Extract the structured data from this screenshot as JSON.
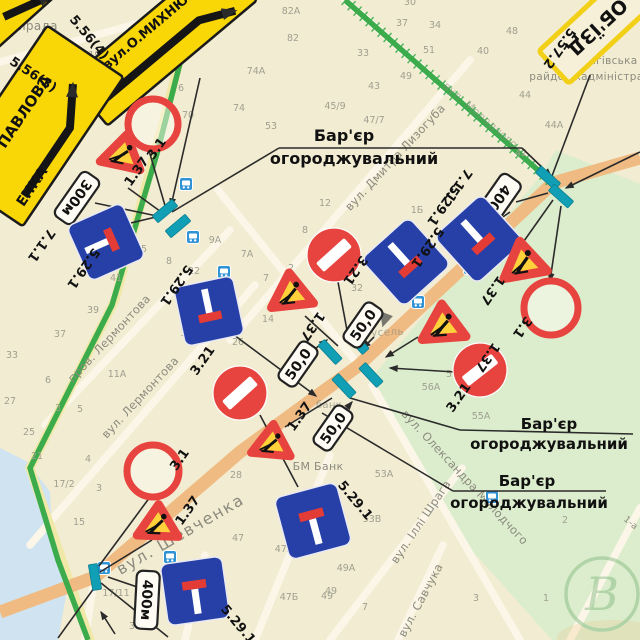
{
  "colors": {
    "paper": "#f2ecd2",
    "park": "#dcedcd",
    "river": "#cfe4f0",
    "street_white": "#fbf6e8",
    "street_yellow": "#f0e8a6",
    "road_orange": "#f0bb82",
    "route_green": "#3bab4b",
    "barrier_teal": "#109fb5",
    "sign_blue": "#2640a8",
    "sign_red": "#e8443f",
    "works_yellow": "#ffd23c",
    "detour_yellow": "#f9d606",
    "plate_face": "#fdfbf3",
    "ink": "#111111",
    "map_gray": "#8b8b7e",
    "number_gray": "#a0a090",
    "line_black": "#2b2b2b"
  },
  "base": {
    "park_poly": "556,150 640,184 640,640 552,640 452,528 368,382 542,174",
    "river_poly": "0,448 28,462 50,492 52,538 68,585 58,640 0,640",
    "streets_white": [
      [
        470,
        60,
        230,
        340
      ],
      [
        230,
        230,
        45,
        425
      ],
      [
        255,
        285,
        30,
        545
      ],
      [
        356,
        362,
        218,
        190
      ],
      [
        372,
        385,
        520,
        640
      ],
      [
        462,
        468,
        330,
        640
      ],
      [
        443,
        545,
        398,
        640
      ],
      [
        0,
        62,
        150,
        20
      ],
      [
        640,
        508,
        570,
        640
      ],
      [
        95,
        573,
        85,
        640
      ],
      [
        330,
        455,
        255,
        640
      ],
      [
        205,
        555,
        185,
        640
      ],
      [
        345,
        0,
        556,
        186
      ]
    ],
    "streets_yellow": [
      [
        196,
        0,
        115,
        300
      ],
      [
        115,
        300,
        30,
        468
      ],
      [
        30,
        468,
        90,
        640
      ]
    ],
    "road_orange": "640,158 553,183 358,366 240,452 95,577 0,612",
    "route_green_main": "196,0 158,150 112,305 30,468 58,560 88,640",
    "route_green_hatched": "345,0 556,186"
  },
  "connectors": [
    [
      200,
      78,
      171,
      206,
      1
    ],
    [
      95,
      203,
      157,
      216,
      0
    ],
    [
      148,
      147,
      166,
      209,
      0
    ],
    [
      128,
      188,
      164,
      214,
      0
    ],
    [
      118,
      226,
      156,
      217,
      0
    ],
    [
      172,
      212,
      279,
      148,
      0
    ],
    [
      279,
      148,
      522,
      148,
      0
    ],
    [
      522,
      148,
      551,
      176,
      1
    ],
    [
      640,
      152,
      566,
      188,
      1
    ],
    [
      590,
      75,
      552,
      176,
      0
    ],
    [
      553,
      200,
      524,
      241,
      0
    ],
    [
      561,
      206,
      550,
      281,
      1
    ],
    [
      548,
      193,
      516,
      202,
      0
    ],
    [
      510,
      212,
      487,
      228,
      0
    ],
    [
      338,
      282,
      349,
      341,
      0
    ],
    [
      305,
      316,
      338,
      346,
      0
    ],
    [
      230,
      332,
      316,
      396,
      1
    ],
    [
      260,
      415,
      298,
      487,
      0
    ],
    [
      418,
      337,
      386,
      357,
      1
    ],
    [
      455,
      372,
      390,
      368,
      1
    ],
    [
      285,
      427,
      332,
      398,
      0
    ],
    [
      150,
      497,
      99,
      566,
      0
    ],
    [
      152,
      540,
      100,
      572,
      0
    ],
    [
      101,
      583,
      168,
      637,
      0
    ],
    [
      97,
      584,
      58,
      638,
      0
    ],
    [
      108,
      577,
      146,
      590,
      0
    ],
    [
      115,
      634,
      101,
      612,
      1
    ],
    [
      312,
      351,
      327,
      340,
      1
    ],
    [
      374,
      337,
      363,
      348,
      1
    ],
    [
      341,
      415,
      352,
      402,
      1
    ],
    [
      350,
      398,
      460,
      430,
      0
    ],
    [
      460,
      430,
      633,
      434,
      0
    ],
    [
      322,
      413,
      453,
      491,
      0
    ],
    [
      453,
      491,
      606,
      491,
      0
    ]
  ],
  "barriers": [
    [
      330,
      352,
      47
    ],
    [
      357,
      342,
      47
    ],
    [
      344,
      386,
      47
    ],
    [
      371,
      375,
      47
    ],
    [
      165,
      211,
      -40
    ],
    [
      178,
      226,
      -40
    ],
    [
      548,
      178,
      42
    ],
    [
      561,
      196,
      42
    ],
    [
      95,
      577,
      80
    ]
  ],
  "bus_stops": [
    [
      186,
      184
    ],
    [
      193,
      237
    ],
    [
      224,
      272
    ],
    [
      470,
      268
    ],
    [
      418,
      302
    ],
    [
      492,
      497
    ],
    [
      170,
      557
    ],
    [
      104,
      568
    ]
  ],
  "pointer_icons": [
    [
      382,
      318,
      -15
    ]
  ],
  "signs": {
    "rings": [
      [
        153,
        124,
        25
      ],
      [
        551,
        308,
        27
      ],
      [
        153,
        471,
        26
      ]
    ],
    "no_entry": [
      [
        334,
        255,
        27,
        -42
      ],
      [
        240,
        393,
        27,
        -42
      ],
      [
        480,
        370,
        27,
        -38
      ]
    ],
    "roadworks": [
      [
        123,
        152,
        28,
        12
      ],
      [
        291,
        291,
        29,
        -6
      ],
      [
        443,
        323,
        30,
        -4
      ],
      [
        523,
        260,
        30,
        -10
      ],
      [
        272,
        441,
        27,
        5
      ],
      [
        158,
        522,
        28,
        2
      ]
    ],
    "dead_end": [
      [
        106,
        242,
        -24,
        60,
        90
      ],
      [
        209,
        311,
        -12,
        60,
        180
      ],
      [
        479,
        239,
        -42,
        64,
        180
      ],
      [
        406,
        262,
        -42,
        64,
        180
      ],
      [
        313,
        521,
        -15,
        64,
        0
      ],
      [
        195,
        591,
        -8,
        62,
        0
      ]
    ],
    "plates": [
      {
        "t": "300м",
        "x": 77,
        "y": 198,
        "r": 125,
        "w": 54,
        "h": 22
      },
      {
        "t": "400м",
        "x": 496,
        "y": 203,
        "r": 125,
        "w": 60,
        "h": 24
      },
      {
        "t": "400м",
        "x": 147,
        "y": 600,
        "r": 93,
        "w": 58,
        "h": 23
      },
      {
        "t": "50,0",
        "x": 298,
        "y": 364,
        "r": -55,
        "w": 46,
        "h": 21
      },
      {
        "t": "50,0",
        "x": 363,
        "y": 325,
        "r": -55,
        "w": 46,
        "h": 21
      },
      {
        "t": "50,0",
        "x": 333,
        "y": 428,
        "r": -55,
        "w": 46,
        "h": 21
      }
    ],
    "labels": [
      [
        "5.56(4)",
        86,
        40,
        50
      ],
      [
        "5.56(3)",
        31,
        78,
        33
      ],
      [
        "5.57.2",
        556,
        46,
        125
      ],
      [
        "7.1.1",
        38,
        243,
        125
      ],
      [
        "5.29.1",
        80,
        266,
        125
      ],
      [
        "5.29.1",
        173,
        283,
        125
      ],
      [
        "3.1",
        160,
        151,
        -55
      ],
      [
        "1.37",
        140,
        174,
        -55
      ],
      [
        "3.21",
        352,
        268,
        125
      ],
      [
        "3.21",
        206,
        363,
        -55
      ],
      [
        "3.21",
        462,
        400,
        -55
      ],
      [
        "1.37",
        309,
        324,
        125
      ],
      [
        "1.37",
        303,
        419,
        -55
      ],
      [
        "1.37",
        484,
        355,
        125
      ],
      [
        "1.37",
        489,
        288,
        125
      ],
      [
        "3.1",
        519,
        325,
        125
      ],
      [
        "3.1",
        183,
        462,
        -55
      ],
      [
        "1.37",
        191,
        513,
        -55
      ],
      [
        "7.1.1",
        455,
        183,
        125
      ],
      [
        "5.29.1",
        440,
        203,
        125
      ],
      [
        "5.29.1",
        424,
        245,
        125
      ],
      [
        "5.29.1",
        352,
        503,
        50
      ],
      [
        "5.29.1",
        235,
        627,
        50
      ]
    ]
  },
  "yellow_signs": [
    {
      "id": "detour-street-sign-mykhnyuka",
      "x": 163,
      "y": 40,
      "r": -40,
      "w": 195,
      "h": 60,
      "face": "#f9d606",
      "edge": "#1a1a1a",
      "ew": 2.5,
      "texts": [
        {
          "t": "вул.О.МИХНЮКА",
          "x": 2,
          "y": -13,
          "s": 13
        }
      ],
      "arrow": "M -80,8 L 40,8 L 74,24"
    },
    {
      "id": "detour-street-sign-pavlova",
      "x": 35,
      "y": 126,
      "r": -56,
      "w": 180,
      "h": 92,
      "face": "#f9d606",
      "edge": "#1a1a1a",
      "ew": 2.5,
      "texts": [
        {
          "t": "ПАВЛОВА",
          "x": 6,
          "y": -12,
          "s": 15
        },
        {
          "t": "ЕНКА",
          "x": -52,
          "y": 36,
          "s": 14
        }
      ],
      "arrow": "M -64,30 L 18,30 L 56,8"
    },
    {
      "id": "detour-street-sign-corner",
      "x": 12,
      "y": -4,
      "r": -42,
      "w": 150,
      "h": 58,
      "face": "#f9d606",
      "edge": "#1a1a1a",
      "ew": 2.5,
      "texts": [
        {
          "t": "ЕНКА",
          "x": 30,
          "y": 24,
          "s": 13
        }
      ],
      "arrow": "M -20,10 L 30,26"
    },
    {
      "id": "detour-plate-objizd",
      "x": 597,
      "y": 27,
      "r": 137,
      "w": 118,
      "h": 44,
      "face": "#f7f0d8",
      "edge": "#f2d018",
      "ew": 5,
      "texts": [
        {
          "t": "ОБ'ЇЗД",
          "x": 0,
          "y": 6,
          "s": 19
        }
      ],
      "arrow": null
    }
  ],
  "barrier_notes": [
    {
      "l1": "Бар'єр",
      "l2": "огороджувальний",
      "x1": 344,
      "y1": 141,
      "x2": 354,
      "y2": 164,
      "s": 16
    },
    {
      "l1": "Бар'єр",
      "l2": "огороджувальний",
      "x1": 549,
      "y1": 429,
      "x2": 549,
      "y2": 449,
      "s": 15
    },
    {
      "l1": "Бар'єр",
      "l2": "огороджувальний",
      "x1": 527,
      "y1": 486,
      "x2": 529,
      "y2": 508,
      "s": 15
    }
  ],
  "street_labels": [
    {
      "t": "райрада",
      "x": 30,
      "y": 30,
      "r": 0,
      "s": 12,
      "o": 1
    },
    {
      "t": "вул. Дмитра Лизогуба",
      "x": 398,
      "y": 160,
      "r": -47,
      "s": 11.5,
      "o": 1
    },
    {
      "t": "пров. Лермонтова",
      "x": 112,
      "y": 341,
      "r": -47,
      "s": 11.5,
      "o": 1
    },
    {
      "t": "вул. Лермонтова",
      "x": 143,
      "y": 400,
      "r": -47,
      "s": 11.5,
      "o": 1
    },
    {
      "t": "вул. Шевченка",
      "x": 183,
      "y": 539,
      "r": -30,
      "s": 16,
      "o": 1
    },
    {
      "t": "вул. Олександра Молодчого",
      "x": 462,
      "y": 480,
      "r": 47,
      "s": 11.5,
      "o": 1
    },
    {
      "t": "вул. Іллі Шрага",
      "x": 424,
      "y": 524,
      "r": -56,
      "s": 11.5,
      "o": 1
    },
    {
      "t": "вул. Савчука",
      "x": 424,
      "y": 602,
      "r": -62,
      "s": 11.5,
      "o": 1
    },
    {
      "t": "вул. Молодчого",
      "x": 478,
      "y": 118,
      "r": 41,
      "s": 11,
      "o": 0.55
    },
    {
      "t": "Чернігівська",
      "x": 601,
      "y": 64,
      "r": 0,
      "s": 10.5,
      "o": 1
    },
    {
      "t": "райдержадміністрація",
      "x": 595,
      "y": 80,
      "r": 0,
      "s": 10.5,
      "o": 1
    },
    {
      "t": "БМ Банк",
      "x": 318,
      "y": 470,
      "r": 0,
      "s": 11,
      "o": 1
    },
    {
      "t": "банк",
      "x": 329,
      "y": 408,
      "r": 0,
      "s": 10,
      "o": 0.7
    },
    {
      "t": "Карусель",
      "x": 377,
      "y": 336,
      "r": -3,
      "s": 10.5,
      "o": 0.65
    },
    {
      "t": "1-а",
      "x": 629,
      "y": 525,
      "r": 40,
      "s": 9,
      "o": 1
    }
  ],
  "house_numbers": [
    [
      "19А",
      66,
      71
    ],
    [
      "19/1",
      99,
      58
    ],
    [
      "17",
      79,
      129
    ],
    [
      "6",
      181,
      91
    ],
    [
      "70",
      188,
      118
    ],
    [
      "74А",
      256,
      74
    ],
    [
      "74",
      239,
      111
    ],
    [
      "82А",
      291,
      14
    ],
    [
      "82",
      293,
      41
    ],
    [
      "53",
      271,
      129
    ],
    [
      "48",
      512,
      34
    ],
    [
      "44",
      525,
      98
    ],
    [
      "44А",
      554,
      128
    ],
    [
      "42",
      521,
      156
    ],
    [
      "40",
      483,
      54
    ],
    [
      "34",
      435,
      28
    ],
    [
      "37",
      402,
      26
    ],
    [
      "30",
      410,
      5
    ],
    [
      "33",
      363,
      56
    ],
    [
      "51",
      429,
      53
    ],
    [
      "49",
      406,
      79
    ],
    [
      "43",
      374,
      89
    ],
    [
      "45/9",
      335,
      109
    ],
    [
      "47/7",
      374,
      123
    ],
    [
      "12",
      325,
      206
    ],
    [
      "1Б",
      417,
      213
    ],
    [
      "2",
      389,
      243
    ],
    [
      "32",
      357,
      291
    ],
    [
      "16",
      186,
      336
    ],
    [
      "45",
      141,
      252
    ],
    [
      "41",
      116,
      281
    ],
    [
      "39",
      93,
      313
    ],
    [
      "37",
      60,
      337
    ],
    [
      "33",
      12,
      358
    ],
    [
      "11А",
      117,
      377
    ],
    [
      "6",
      48,
      383
    ],
    [
      "3",
      58,
      411
    ],
    [
      "5",
      80,
      412
    ],
    [
      "27",
      10,
      404
    ],
    [
      "8",
      169,
      264
    ],
    [
      "22",
      194,
      274
    ],
    [
      "9А",
      215,
      243
    ],
    [
      "7А",
      247,
      257
    ],
    [
      "7",
      266,
      281
    ],
    [
      "2",
      291,
      271
    ],
    [
      "14",
      268,
      322
    ],
    [
      "26",
      238,
      345
    ],
    [
      "8",
      305,
      233
    ],
    [
      "25",
      29,
      435
    ],
    [
      "21",
      37,
      459
    ],
    [
      "4",
      88,
      462
    ],
    [
      "17/2",
      64,
      487
    ],
    [
      "3",
      99,
      491
    ],
    [
      "15",
      79,
      525
    ],
    [
      "28",
      236,
      478
    ],
    [
      "47",
      238,
      541
    ],
    [
      "47А",
      284,
      552
    ],
    [
      "47Б",
      289,
      600
    ],
    [
      "49",
      327,
      599
    ],
    [
      "17/11",
      116,
      596
    ],
    [
      "39",
      135,
      629
    ],
    [
      "53А",
      384,
      477
    ],
    [
      "53В",
      372,
      522
    ],
    [
      "49А",
      346,
      571
    ],
    [
      "49",
      331,
      594
    ],
    [
      "7",
      365,
      610
    ],
    [
      "55",
      452,
      377
    ],
    [
      "56А",
      431,
      390
    ],
    [
      "55А",
      481,
      419
    ],
    [
      "2",
      565,
      523
    ],
    [
      "3",
      476,
      601
    ],
    [
      "1",
      546,
      601
    ]
  ],
  "watermark": {
    "letter": "В",
    "x": 602,
    "y": 594,
    "r": 36
  }
}
